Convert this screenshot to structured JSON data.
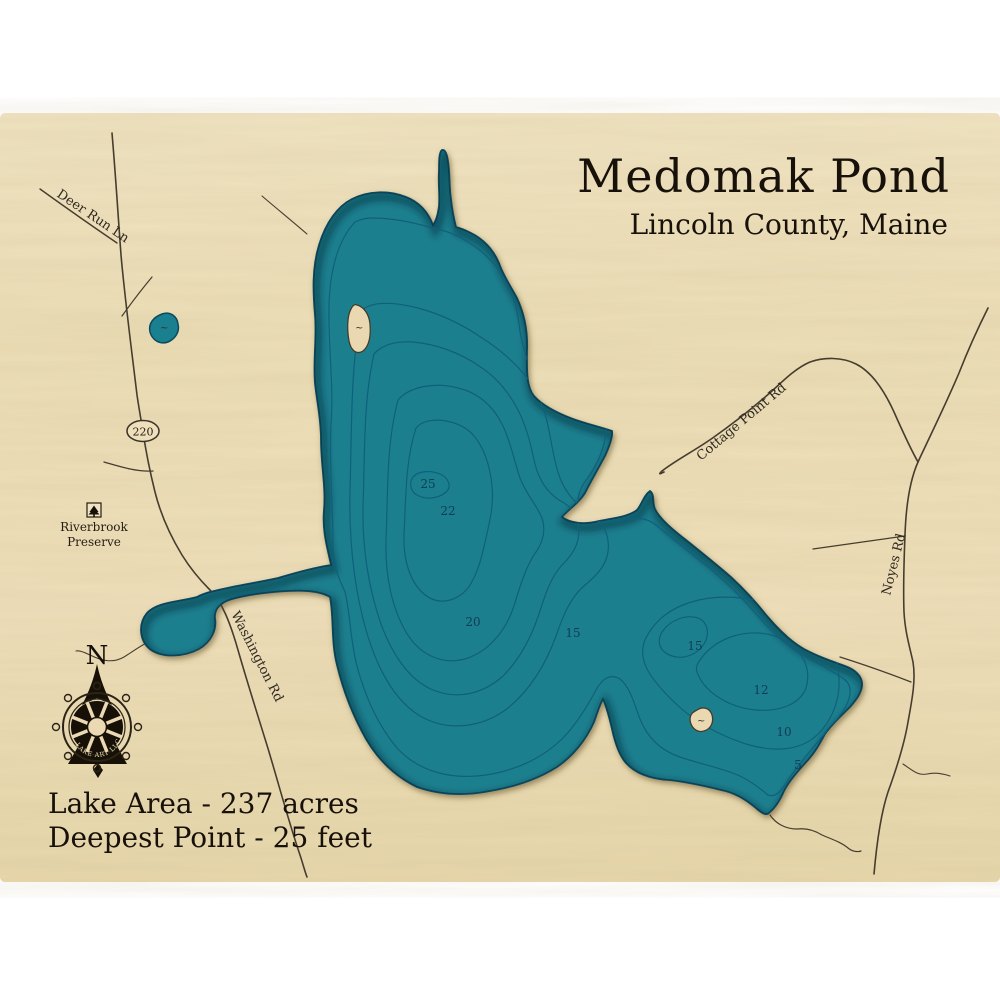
{
  "title": {
    "name": "Medomak Pond",
    "location": "Lincoln County, Maine"
  },
  "stats": {
    "lake_area": "Lake Area - 237 acres",
    "deepest_point": "Deepest Point - 25 feet"
  },
  "compass": {
    "north_label": "N",
    "logo_text": "LAKE ART LLC"
  },
  "route_shield": {
    "number": "220"
  },
  "roads": {
    "deer_run": "Deer Run Ln",
    "washington": "Washington Rd",
    "cottage_point": "Cottage Point Rd",
    "noyes": "Noyes Rd"
  },
  "preserve": {
    "line1": "Riverbrook",
    "line2": "Preserve"
  },
  "depths": [
    "25",
    "22",
    "20",
    "15",
    "15",
    "12",
    "10",
    "5"
  ],
  "island_mark": "~",
  "pond_mark": "~",
  "colors": {
    "wood": "#eddfb8",
    "lake": "#1a7f8e",
    "contour": "#10607b",
    "shore": "#0b4a5e",
    "road": "#463d2f",
    "ink": "#1d160c"
  }
}
